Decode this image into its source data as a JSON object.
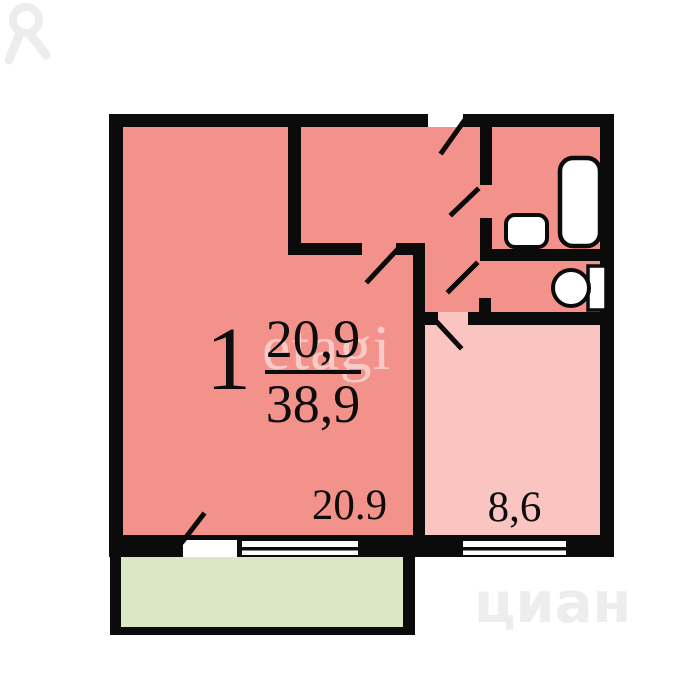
{
  "plan": {
    "room_number": "1",
    "living_area": "20,9",
    "total_area": "38,9",
    "room_area_label": "20.9",
    "kitchen_area_label": "8,6",
    "fixtures": [
      "bathtub",
      "sink",
      "toilet"
    ]
  },
  "watermarks": {
    "center_text": "etagi",
    "brand_text": "циан"
  },
  "colors": {
    "wall": "#0b0b0b",
    "room_fill": "#f3918b",
    "kitchen_fill": "#fac5c1",
    "balcony_fill": "#dce7c5",
    "fixture_fill": "#ffffff",
    "brand_watermark": "#ededed",
    "background": "#ffffff"
  }
}
